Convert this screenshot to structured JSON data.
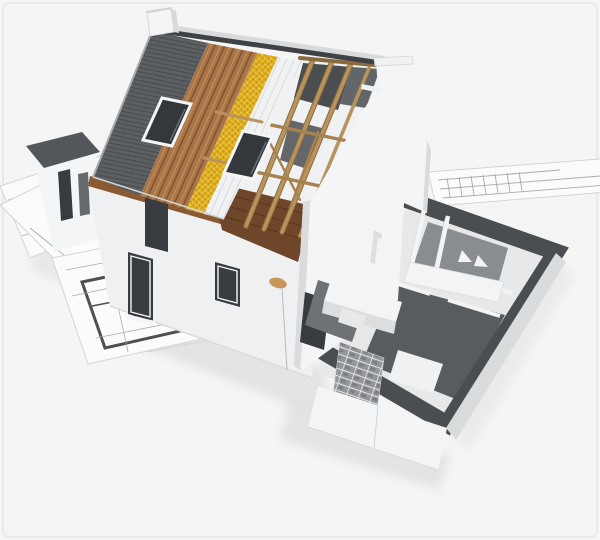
{
  "meta": {
    "type": "3d-architectural-render",
    "description": "Isometric 3D cutaway rendering of a house under construction sitting on architectural blueprint sheets. The gable roof is peeled back in layers: dark tiles, wood sheathing, yellow insulation, white underlayment battens and exposed timber rafters. A white bell-shaped gable chimney wall stands at the right, and a single-storey extension is shown as an open floor plan with dark wall tops, a bathroom, kitchen units, an unfinished brick wall and white rendered outer walls.",
    "no_visible_text": true
  },
  "scene": {
    "roof_layers": [
      {
        "name": "tile-roof",
        "material": "dark grey roof tiles"
      },
      {
        "name": "wood-sheathing",
        "material": "brown timber boards"
      },
      {
        "name": "insulation-strip",
        "material": "yellow mineral wool"
      },
      {
        "name": "underlayment-battens",
        "material": "white membrane with battens"
      },
      {
        "name": "exposed-rafters",
        "material": "tan timber trusses"
      }
    ],
    "skylight_count": 2,
    "chimneys": [
      "ridge-chimney",
      "gable-bell-chimney"
    ],
    "house_parts": [
      "front-wall",
      "left-wing",
      "gable-end-wall",
      "roof-soffit",
      "attic-floor"
    ],
    "front_wall_openings": 3,
    "extension_rooms": [
      "bathroom",
      "kitchen",
      "living-room"
    ],
    "extension_features": [
      "dark-wall-tops",
      "bathtub",
      "shower-panels",
      "kitchen-units",
      "brick-infill-wall",
      "patio-opening",
      "white-outer-walls"
    ],
    "blueprint_sheets": 4,
    "accessories": [
      "plumb-line"
    ]
  },
  "colors": {
    "bg": "#f5f5f6",
    "frame": "#e9e9ea",
    "sheet": "#fbfbfc",
    "sheet_edge": "#d2d4d5",
    "plan_wall": "#4d5053",
    "plan_line": "#a8abad",
    "shadow": "#dcdddf",
    "tile_base": "#5e6164",
    "tile_line": "#4a4d50",
    "tile_edge": "#a8abad",
    "ridge_cap": "#3f4245",
    "far_slope": "#d9dadc",
    "wood_base": "#a9744a",
    "wood_line": "#7d4d27",
    "insul_base": "#e0b124",
    "insul_dark": "#c1920c",
    "insul_light": "#f0d160",
    "batten_base": "#f0f1f2",
    "batten_line": "#d9dadd",
    "rafter": "#b8935e",
    "rafter_dark": "#8a6a3d",
    "purlin": "#a6824e",
    "attic_floor": "#6e462a",
    "attic_line": "#59371f",
    "soffit": "#8a5a33",
    "wall_white": "#f4f5f6",
    "wall_front": "#eef0f1",
    "wall_side": "#d9dbdd",
    "chimney_side": "#d7d9db",
    "dark_top": "#4b4e51",
    "dark_top2": "#53565a",
    "opening": "#383b3f",
    "glass": "#34373b",
    "glass_frame": "#f4f5f6",
    "floor": "#e7e8ea",
    "mid_floor": "#595c5f",
    "bath_floor": "#8a8d90",
    "kitchen_floor": "#6f7275",
    "fixture_white": "#f3f4f5",
    "fixture_side": "#dcdee0",
    "brick_base": "#94979a",
    "brick_joint": "#f2f3f4",
    "brick_hole": "#5e6165",
    "partition_face": "#c2c4c7",
    "plumb_tan": "#c9955c",
    "plumb_string": "#b8babc"
  }
}
